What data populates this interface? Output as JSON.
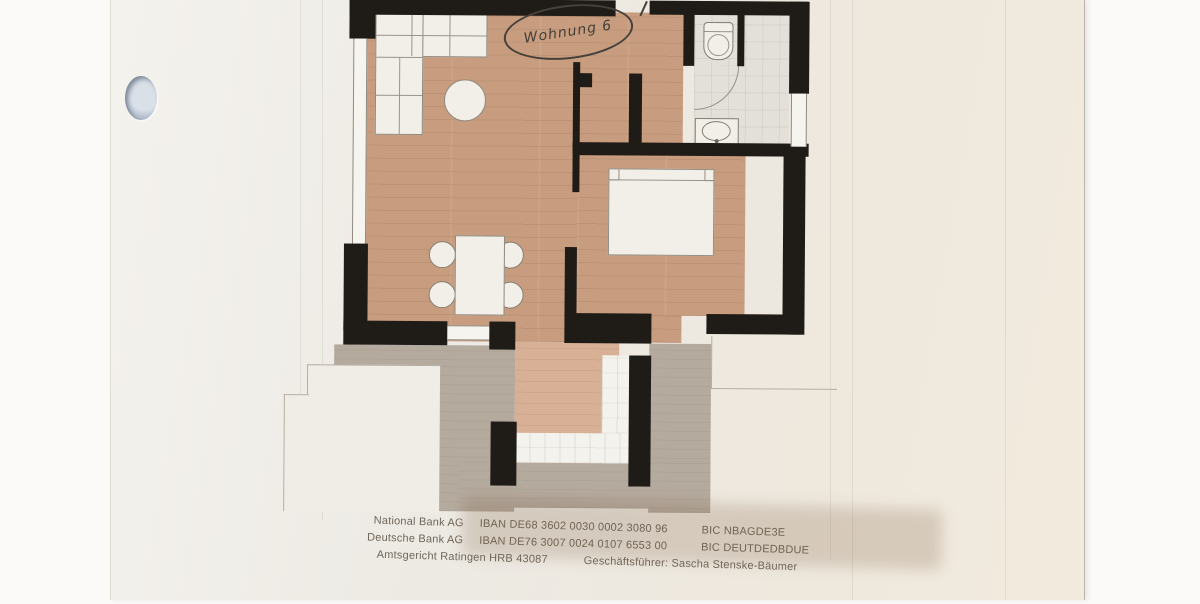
{
  "document": {
    "type_label": "floor-plan-photo",
    "annotation": {
      "text": "Wohnung 6"
    },
    "legal": {
      "rows": [
        {
          "org": "National Bank AG",
          "iban": "IBAN DE68 3602 0030 0002 3080 96",
          "bic": "BIC NBAGDE3E"
        },
        {
          "org": "Deutsche Bank AG",
          "iban": "IBAN DE76 3007 0024 0107 6553 00",
          "bic": "BIC DEUTDEDBDUE"
        }
      ],
      "registry": "Amtsgericht Ratingen HRB 43087",
      "ceo": "Geschäftsführer: Sascha Stenske-Bäumer"
    },
    "colors": {
      "wall": "#1f1b17",
      "wood_floor": "#c89d7f",
      "corridor_wood": "#d8b095",
      "terrace": "#b5aa9e",
      "bath_tile": "#e3e0d9",
      "entry_tile": "#f4f2ec",
      "paper": "#edeae4",
      "ink": "#6e6559",
      "annotation_ink": "#46403a",
      "punch_hole": "#b9c4d2"
    }
  }
}
